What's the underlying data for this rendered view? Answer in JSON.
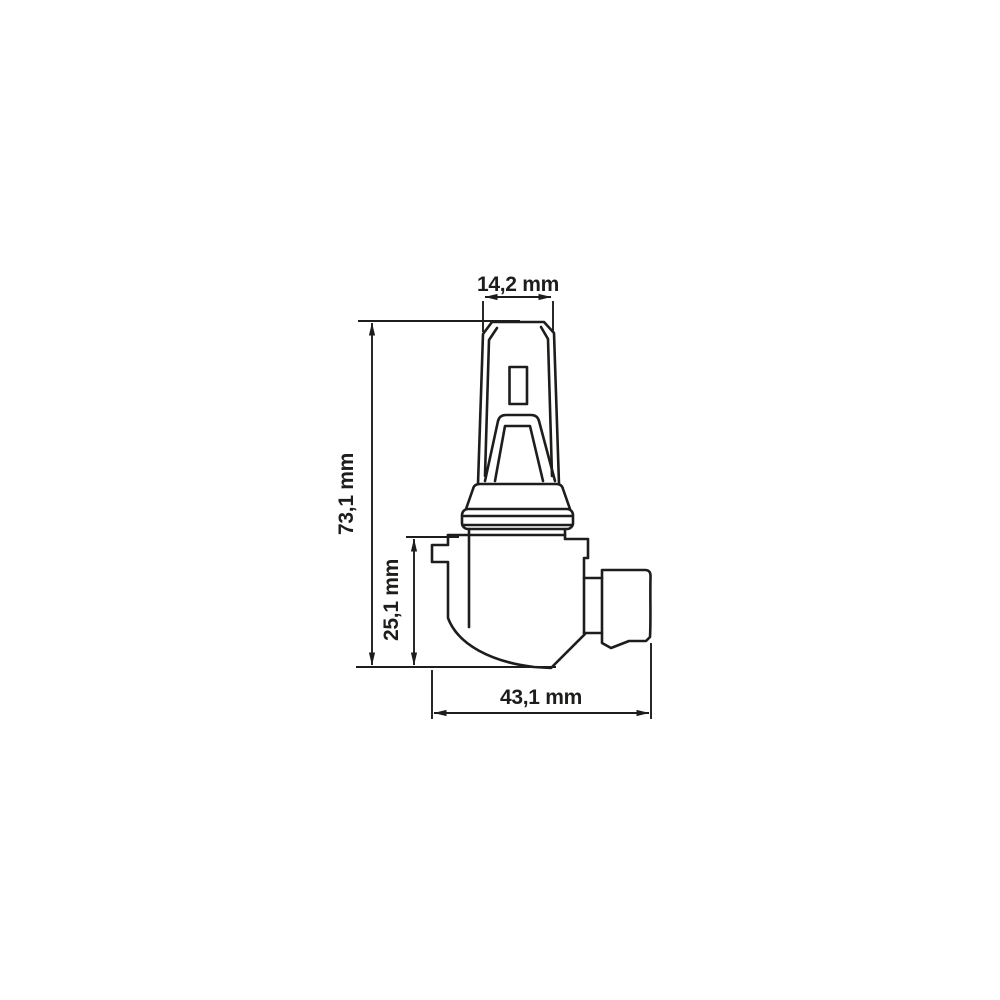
{
  "drawing": {
    "kind": "technical-dimension-drawing",
    "units": "mm",
    "line_color": "#1d1d1b",
    "background_color": "#ffffff",
    "dimensions": {
      "top_width": {
        "label": "14,2 mm",
        "value": 14.2
      },
      "total_height": {
        "label": "73,1 mm",
        "value": 73.1
      },
      "base_height": {
        "label": "25,1 mm",
        "value": 25.1
      },
      "base_width": {
        "label": "43,1 mm",
        "value": 43.1
      }
    }
  }
}
